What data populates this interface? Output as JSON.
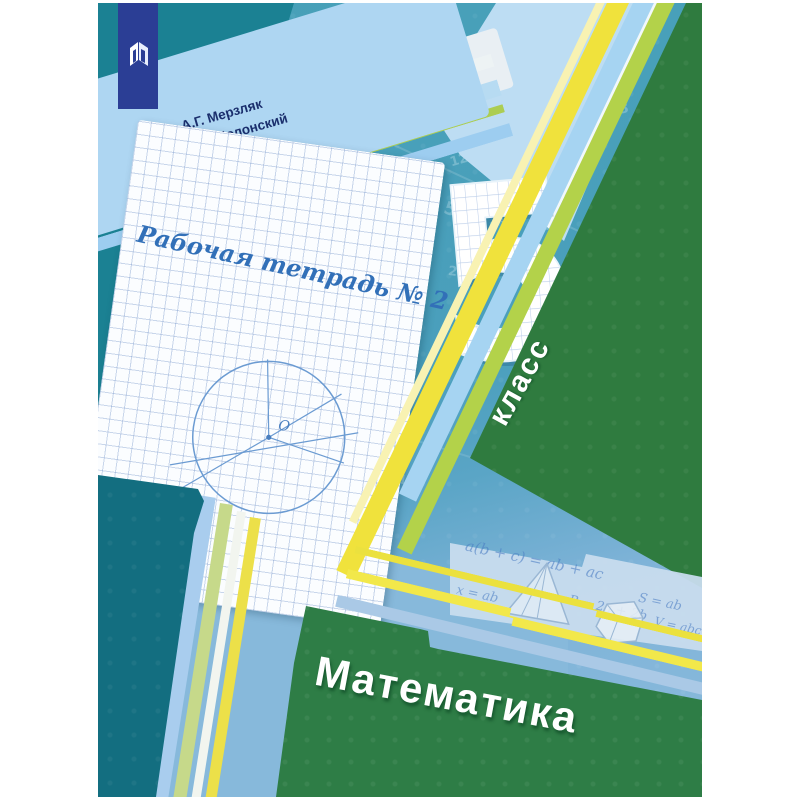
{
  "cover": {
    "authors": [
      "А.Г. Мерзляк",
      "В.Б. Полонский",
      "М.С. Якир"
    ],
    "workbook_label": "Рабочая тетрадь № 2",
    "grade": {
      "number": "5",
      "word": "класс"
    },
    "title": "Математика",
    "circle_center_label": "O",
    "formulas": [
      "a(b + c) = ab + ac",
      "x = ab",
      "P = 2a + 2b",
      "S = ab",
      "V = abc"
    ],
    "background_digits": [
      "2",
      "48",
      "7",
      "3",
      "8",
      "245",
      "12",
      "0,215",
      "9",
      "5",
      "0,4",
      "71",
      "6",
      "24",
      "8",
      "3",
      "0,5",
      "2",
      "9",
      "4",
      "8",
      "1"
    ],
    "colors": {
      "dark_teal": "#1b8193",
      "base_teal": "#4a9fbc",
      "light_blue": "#85b8da",
      "green_panel": "#2f7b3f",
      "green_folder": "#2e7d46",
      "yellow_stripe": "#f0e23c",
      "banner_blue": "#2b3e95",
      "paper_white": "#fbfdff"
    }
  }
}
